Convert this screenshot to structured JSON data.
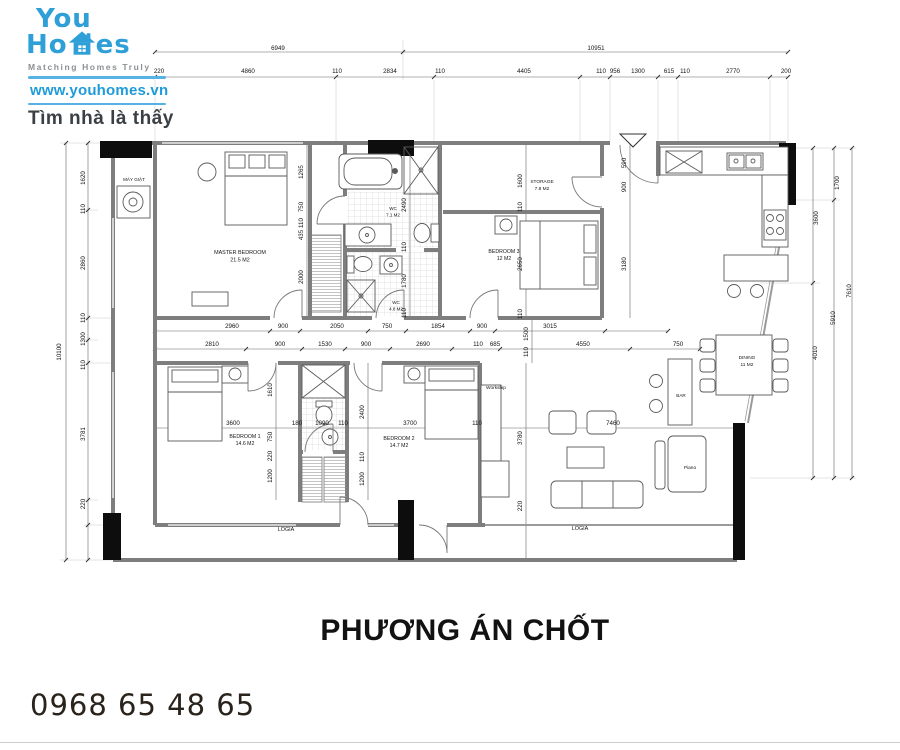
{
  "brand": {
    "logo_you": "You",
    "logo_ho": "Ho",
    "logo_es": "es",
    "tagline": "Matching Homes Truly",
    "website": "www.youhomes.vn",
    "slogan": "Tìm nhà là thấy",
    "brand_blue": "#2f9fd8",
    "rule_blue": "#55b2e2"
  },
  "footer": {
    "phone": "0968 65 48 65"
  },
  "plan": {
    "title": "PHƯƠNG ÁN CHỐT",
    "wall_gray": "#7e7e7e",
    "pillar_black": "#0d0d0d",
    "room_labels": [
      {
        "lines": [
          "MÁY GIẶT"
        ],
        "x": 134,
        "y": 181,
        "fs": 4.6
      },
      {
        "lines": [
          "MASTER BEDROOM",
          "21.5 M2"
        ],
        "x": 240,
        "y": 254,
        "fs": 5.4
      },
      {
        "lines": [
          "WC",
          "7.1 M2"
        ],
        "x": 393,
        "y": 210,
        "fs": 4.5
      },
      {
        "lines": [
          "WC",
          "4.8 M2"
        ],
        "x": 396,
        "y": 304,
        "fs": 4.5
      },
      {
        "lines": [
          "STORAGE",
          "7.8 M2"
        ],
        "x": 542,
        "y": 183,
        "fs": 4.8
      },
      {
        "lines": [
          "BEDROOM 3",
          "12 M2"
        ],
        "x": 504,
        "y": 253,
        "fs": 5.2
      },
      {
        "lines": [
          "BEDROOM 1",
          "14.6 M2"
        ],
        "x": 245,
        "y": 438,
        "fs": 5.2
      },
      {
        "lines": [
          "BEDROOM 2",
          "14.7 M2"
        ],
        "x": 399,
        "y": 440,
        "fs": 5.2
      },
      {
        "lines": [
          "Workship"
        ],
        "x": 496,
        "y": 389,
        "fs": 4.8
      },
      {
        "lines": [
          "DINING",
          "11 M2"
        ],
        "x": 747,
        "y": 359,
        "fs": 4.8
      },
      {
        "lines": [
          "BAR"
        ],
        "x": 681,
        "y": 397,
        "fs": 4.6
      },
      {
        "lines": [
          "Piano"
        ],
        "x": 690,
        "y": 469,
        "fs": 4.8
      },
      {
        "lines": [
          "LOGIA"
        ],
        "x": 286,
        "y": 531,
        "fs": 5.4
      },
      {
        "lines": [
          "LOGIA"
        ],
        "x": 580,
        "y": 530,
        "fs": 5.4
      }
    ],
    "dim_labels": [
      {
        "t": "6949",
        "x": 278,
        "y": 50
      },
      {
        "t": "10951",
        "x": 596,
        "y": 50
      },
      {
        "t": "220",
        "x": 159,
        "y": 73
      },
      {
        "t": "4860",
        "x": 248,
        "y": 73
      },
      {
        "t": "110",
        "x": 337,
        "y": 73
      },
      {
        "t": "2834",
        "x": 390,
        "y": 73
      },
      {
        "t": "110",
        "x": 440,
        "y": 73
      },
      {
        "t": "4405",
        "x": 524,
        "y": 73
      },
      {
        "t": "110",
        "x": 601,
        "y": 73
      },
      {
        "t": "956",
        "x": 615,
        "y": 73
      },
      {
        "t": "1300",
        "x": 638,
        "y": 73
      },
      {
        "t": "615",
        "x": 669,
        "y": 73
      },
      {
        "t": "110",
        "x": 685,
        "y": 73
      },
      {
        "t": "2770",
        "x": 733,
        "y": 73
      },
      {
        "t": "200",
        "x": 786,
        "y": 73
      },
      {
        "t": "10100",
        "x": 61,
        "y": 352,
        "r": 1
      },
      {
        "t": "1620",
        "x": 85,
        "y": 178,
        "r": 1
      },
      {
        "t": "110",
        "x": 85,
        "y": 209,
        "r": 1
      },
      {
        "t": "2860",
        "x": 85,
        "y": 263,
        "r": 1
      },
      {
        "t": "110",
        "x": 85,
        "y": 318,
        "r": 1
      },
      {
        "t": "1300",
        "x": 85,
        "y": 339,
        "r": 1
      },
      {
        "t": "110",
        "x": 85,
        "y": 365,
        "r": 1
      },
      {
        "t": "3781",
        "x": 85,
        "y": 434,
        "r": 1
      },
      {
        "t": "220",
        "x": 85,
        "y": 504,
        "r": 1
      },
      {
        "t": "1700",
        "x": 839,
        "y": 183,
        "r": 1
      },
      {
        "t": "3600",
        "x": 818,
        "y": 218,
        "r": 1
      },
      {
        "t": "7610",
        "x": 851,
        "y": 291,
        "r": 1
      },
      {
        "t": "5910",
        "x": 835,
        "y": 318,
        "r": 1
      },
      {
        "t": "4010",
        "x": 817,
        "y": 353,
        "r": 1
      },
      {
        "t": "2960",
        "x": 232,
        "y": 328
      },
      {
        "t": "900",
        "x": 283,
        "y": 328
      },
      {
        "t": "2050",
        "x": 337,
        "y": 328
      },
      {
        "t": "750",
        "x": 387,
        "y": 328
      },
      {
        "t": "1854",
        "x": 438,
        "y": 328
      },
      {
        "t": "900",
        "x": 482,
        "y": 328
      },
      {
        "t": "3015",
        "x": 550,
        "y": 328
      },
      {
        "t": "2810",
        "x": 212,
        "y": 346
      },
      {
        "t": "900",
        "x": 280,
        "y": 346
      },
      {
        "t": "1530",
        "x": 325,
        "y": 346
      },
      {
        "t": "900",
        "x": 366,
        "y": 346
      },
      {
        "t": "2690",
        "x": 423,
        "y": 346
      },
      {
        "t": "110",
        "x": 478,
        "y": 346
      },
      {
        "t": "685",
        "x": 495,
        "y": 346
      },
      {
        "t": "4550",
        "x": 583,
        "y": 346
      },
      {
        "t": "750",
        "x": 678,
        "y": 346
      },
      {
        "t": "1265",
        "x": 303,
        "y": 172,
        "r": 1
      },
      {
        "t": "750",
        "x": 303,
        "y": 207,
        "r": 1
      },
      {
        "t": "110",
        "x": 303,
        "y": 223,
        "r": 1
      },
      {
        "t": "435",
        "x": 303,
        "y": 235,
        "r": 1
      },
      {
        "t": "2000",
        "x": 303,
        "y": 277,
        "r": 1
      },
      {
        "t": "2490",
        "x": 406,
        "y": 205,
        "r": 1
      },
      {
        "t": "110",
        "x": 406,
        "y": 247,
        "r": 1
      },
      {
        "t": "1780",
        "x": 406,
        "y": 281,
        "r": 1
      },
      {
        "t": "110",
        "x": 406,
        "y": 313,
        "r": 1
      },
      {
        "t": "1600",
        "x": 522,
        "y": 181,
        "r": 1
      },
      {
        "t": "110",
        "x": 522,
        "y": 207,
        "r": 1
      },
      {
        "t": "2650",
        "x": 522,
        "y": 264,
        "r": 1
      },
      {
        "t": "110",
        "x": 522,
        "y": 314,
        "r": 1
      },
      {
        "t": "590",
        "x": 626,
        "y": 163,
        "r": 1
      },
      {
        "t": "900",
        "x": 626,
        "y": 187,
        "r": 1
      },
      {
        "t": "3180",
        "x": 626,
        "y": 264,
        "r": 1
      },
      {
        "t": "1610",
        "x": 272,
        "y": 390,
        "r": 1
      },
      {
        "t": "750",
        "x": 272,
        "y": 437,
        "r": 1
      },
      {
        "t": "220",
        "x": 272,
        "y": 456,
        "r": 1
      },
      {
        "t": "1200",
        "x": 272,
        "y": 476,
        "r": 1
      },
      {
        "t": "2400",
        "x": 364,
        "y": 412,
        "r": 1
      },
      {
        "t": "110",
        "x": 364,
        "y": 457,
        "r": 1
      },
      {
        "t": "1200",
        "x": 364,
        "y": 479,
        "r": 1
      },
      {
        "t": "1500",
        "x": 528,
        "y": 334,
        "r": 1
      },
      {
        "t": "110",
        "x": 528,
        "y": 352,
        "r": 1
      },
      {
        "t": "3780",
        "x": 522,
        "y": 438,
        "r": 1
      },
      {
        "t": "220",
        "x": 522,
        "y": 506,
        "r": 1
      },
      {
        "t": "3600",
        "x": 233,
        "y": 425
      },
      {
        "t": "180",
        "x": 297,
        "y": 425
      },
      {
        "t": "1090",
        "x": 322,
        "y": 425
      },
      {
        "t": "110",
        "x": 343,
        "y": 425
      },
      {
        "t": "3700",
        "x": 410,
        "y": 425
      },
      {
        "t": "110",
        "x": 477,
        "y": 425
      },
      {
        "t": "7460",
        "x": 613,
        "y": 425
      }
    ]
  }
}
